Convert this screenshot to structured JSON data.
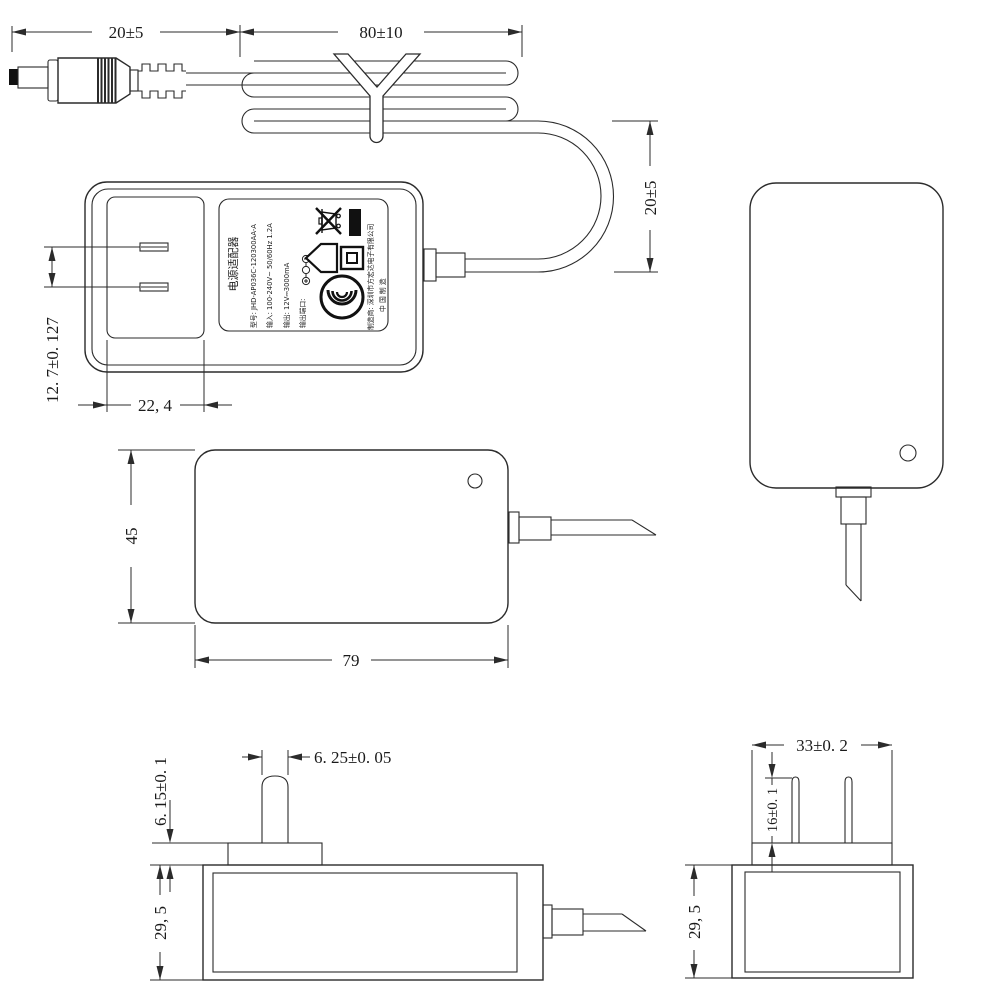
{
  "drawing": {
    "kind": "power adapter dimensional drawing"
  },
  "dims": {
    "dc_plug_length": "20±5",
    "coil_length": "80±10",
    "cable_loop_height": "20±5",
    "prong_pitch": "12. 7±0. 127",
    "recess_width": "22, 4",
    "body_width": "45",
    "body_length": "79",
    "prong_blade_width": "6. 25±0. 05",
    "boss_height": "6. 15±0. 1",
    "body_thickness": "29, 5",
    "head_width": "33±0. 2",
    "prong_length": "16±0. 1",
    "body_thickness_end": "29, 5"
  },
  "label": {
    "title": "电源适配器",
    "model": "型号: JHD-AP036C-120300AA-A",
    "input": "输入: 100-240V~ 50/60Hz 1.2A",
    "output": "输出: 12V⎓3000mA",
    "output_port": "输出端口:",
    "manufacturer": "制造商: 深圳市方宏达电子有限公司",
    "origin": "中 国 制 造"
  },
  "icons": {
    "weee": "crossed-out-wheeled-bin",
    "weee_bar": "black-bar",
    "arrow": "pentagon-arrow",
    "class_ii": "double-square-class-ii",
    "ccc": "ccc-certification-mark",
    "polarity": "dc-polarity-circles"
  }
}
